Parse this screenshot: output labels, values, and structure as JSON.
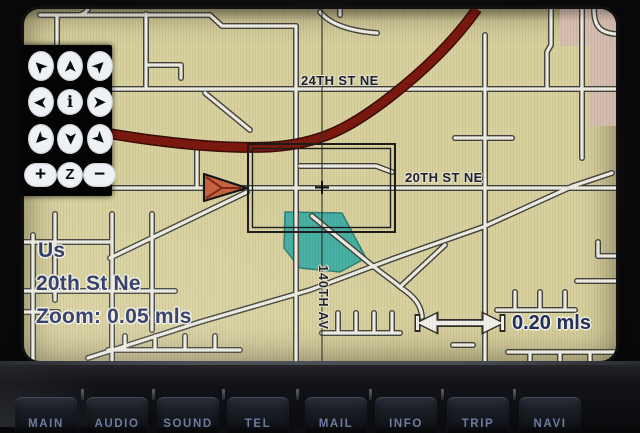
{
  "screen": {
    "street_labels": {
      "label_24th": "24TH ST NE",
      "label_20th": "20TH ST NE",
      "label_140th": "140TH AV"
    },
    "status": {
      "country": "Us",
      "street": "20th St Ne",
      "zoom": "Zoom: 0.05 mls"
    },
    "scale": {
      "distance": "0.20 mls"
    },
    "colors": {
      "map_background": "#d8d19e",
      "road_fill": "#eeede4",
      "road_casing": "#45443c",
      "arterial_red": "#7c190f",
      "water_teal": "#46b0a3",
      "label_navy": "#2b3765",
      "marker_orange": "#c8643f"
    }
  },
  "control_pad": {
    "buttons": [
      {
        "name": "scroll-up-left",
        "glyph": "➤"
      },
      {
        "name": "scroll-up",
        "glyph": "➤"
      },
      {
        "name": "scroll-up-right",
        "glyph": "➤"
      },
      {
        "name": "scroll-left",
        "glyph": "➤"
      },
      {
        "name": "info",
        "glyph": "i"
      },
      {
        "name": "scroll-right",
        "glyph": "➤"
      },
      {
        "name": "scroll-down-left",
        "glyph": "➤"
      },
      {
        "name": "scroll-down",
        "glyph": "➤"
      },
      {
        "name": "scroll-down-right",
        "glyph": "➤"
      },
      {
        "name": "zoom-in",
        "glyph": "+"
      },
      {
        "name": "zoom",
        "glyph": "Z"
      },
      {
        "name": "zoom-out",
        "glyph": "−"
      }
    ]
  },
  "hard_buttons": {
    "items": [
      {
        "label": "MAIN"
      },
      {
        "label": "AUDIO"
      },
      {
        "label": "SOUND"
      },
      {
        "label": "TEL"
      },
      {
        "label": "MAIL"
      },
      {
        "label": "INFO"
      },
      {
        "label": "TRIP"
      },
      {
        "label": "NAVI"
      }
    ]
  }
}
